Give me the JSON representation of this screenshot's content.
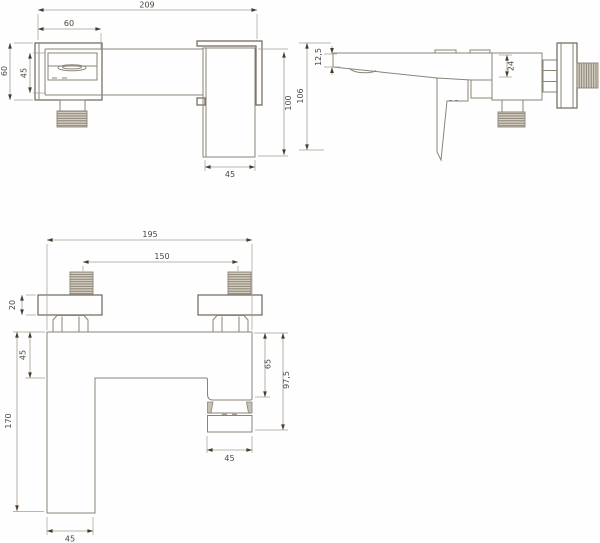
{
  "colors": {
    "background": "#fefefe",
    "line": "#8a8478",
    "line_dark": "#6e6558",
    "dimension": "#a39d93",
    "arrow": "#4a3b2c",
    "text": "#4b453e",
    "thread_fill": "#d8d2c6",
    "thread_stripe": "#7e7668",
    "collar_fill": "#c8c1b3"
  },
  "drawing": {
    "type": "technical-dimension-drawing",
    "subject": "wall-mounted bath shower mixer tap, three orthographic views",
    "top_view": {
      "dims": {
        "total_width": "209",
        "spout_offset": "60",
        "total_depth": "60",
        "body_depth": "45",
        "outlet_length": "100",
        "outlet_width": "45"
      }
    },
    "side_view": {
      "dims": {
        "spout_tip_height": "12,5",
        "spout_root_height": "24",
        "total_height": "106"
      }
    },
    "front_view": {
      "dims": {
        "total_width": "195",
        "inlet_spacing": "150",
        "plate_thickness": "20",
        "body_height": "45",
        "step_depth": "65",
        "outlet_drop": "97,5",
        "column_drop": "170",
        "outlet_width": "45",
        "column_width": "45"
      }
    }
  }
}
